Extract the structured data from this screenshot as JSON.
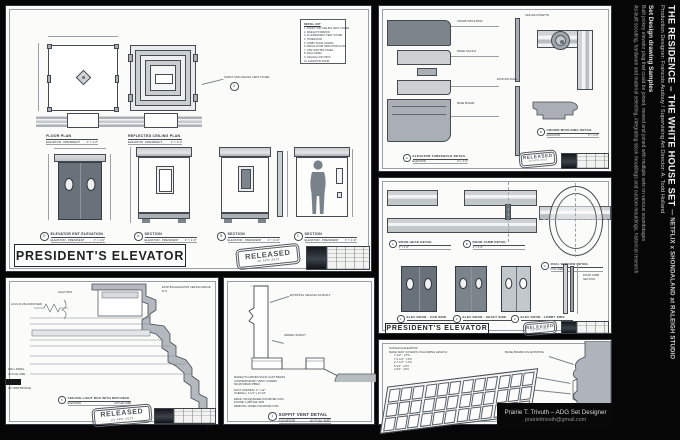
{
  "colors": {
    "bg": "#060606",
    "sheet": "#fbfbfa",
    "ink": "#30363c",
    "fill_light": "#ccd0d3",
    "fill_mid": "#a9afb4",
    "fill_dark": "#656d75"
  },
  "sidebar": {
    "title_main": "THE RESIDENCE – THE WHITE HOUSE SET ",
    "title_suffix": "—  NETFLIX x SHONDALAND at RALEIGH STUDIO",
    "credit_line": "Production Designer: Francois Audouy  /  Supervising Art Director: A. Todd Holland",
    "samples_heading": "Set Design drawing Samples",
    "samples_line1": "Built jockey elevator plug that could be joined, moved and joined with multiple sets on various soundstages",
    "samples_line2": "As-built scouting, hardware and material selecting, integrating stock mouldings and custom mouldings, historical research",
    "logo_number": "800"
  },
  "credit": {
    "name": "Prairie T. Trivuth – ADG Set Designer",
    "email": "prairiettrivuth@gmail.com"
  },
  "stamp": {
    "label": "RELEASED",
    "date": "20-APR-2023"
  },
  "plans_sheet": {
    "title_box": "PRESIDENT'S ELEVATOR",
    "detail_list": {
      "title": "DETAIL LIST",
      "items": [
        "SOFFIT AND CEILING VENT COVER",
        "SIDE EXIT MIRROR",
        "FLUORESCENT VENT COVER",
        "THRESHOLD",
        "LOBBY DOOR CASING",
        "ABOVE DOOR INDICATOR PLATE",
        "CAB CONTROL PANEL",
        "WALL PANEL",
        "CEILING LIGHT BOX",
        "ELEVATOR DOOR"
      ]
    },
    "floor_plan": {
      "title": "FLOOR PLAN",
      "sub": "ELEVATOR - PRESIDENT",
      "scale": "1\" = 1'-0\""
    },
    "rcp": {
      "title": "REFLECTED CEILING PLAN",
      "sub": "ELEVATOR - PRESIDENT",
      "scale": "1\" = 1'-0\""
    },
    "vent_note": "SOFFIT AND CEILING VENT COVER",
    "elevations": [
      {
        "letter": "D",
        "title": "ELEVATOR ENT ELEVATION",
        "sub": "ELEVATOR - PRESIDENT",
        "scale": "1\" = 1'-0\""
      },
      {
        "letter": "A",
        "title": "SECTION",
        "sub": "ELEVATOR - PRESIDENT",
        "scale": "1\" = 1'-0\""
      },
      {
        "letter": "B",
        "title": "SECTION",
        "sub": "ELEVATOR - PRESIDENT",
        "scale": "1\" = 1'-0\""
      },
      {
        "letter": "C",
        "title": "SECTION",
        "sub": "ELEVATOR - PRESIDENT",
        "scale": "1\" = 1'-0\""
      }
    ]
  },
  "moulding_sheet": {
    "caption_a": {
      "letter": "A",
      "title": "ELEVATOR THRESHOLD DETAIL",
      "sub": "ELEVATOR",
      "scale": "3\" = 1'-0\""
    },
    "caption_b": {
      "letter": "B",
      "title": "CROWN MOULDING DETAIL",
      "sub": "ELEVATOR",
      "scale": "3\" = 1'-0\""
    },
    "labels": {
      "rosette": "CEILING ROSETTE",
      "corner": "CEILING CORNER PLAN",
      "crown": "CROWN MOULDING",
      "panel": "PANEL MOULD",
      "base": "BASE BOARD",
      "wall": "EXISTING WALL"
    }
  },
  "doors_sheet": {
    "title_box": "PRESIDENT'S ELEVATOR",
    "captions_top": [
      {
        "letter": "A",
        "title": "DOOR HEAD DETAIL",
        "scale": "3\" = 1'-0\""
      },
      {
        "letter": "B",
        "title": "DOOR JAMB DETAIL",
        "scale": "3\" = 1'-0\""
      },
      {
        "letter": "C",
        "title": "OVAL WINDOW DETAIL",
        "scale": "FULL SIZE"
      }
    ],
    "captions_doors": [
      {
        "letter": "1",
        "title": "ELEV DOOR - CAB SIDE"
      },
      {
        "letter": "2",
        "title": "ELEV DOOR - SHAFT SIDE"
      },
      {
        "letter": "3",
        "title": "ELEV DOOR - LOBBY SIDE"
      },
      {
        "letter": "4",
        "title": "DOOR JAMB SECTION"
      }
    ]
  },
  "crown_sheet": {
    "labels": {
      "hvls": "HVLS FLUSH DIFFUSER",
      "light_box": "LIGHT BOX",
      "existing": "EXISTING ELEVATOR CEILING ABOVE R.O.",
      "wall_panel": "WALL PANEL",
      "actual": "ACTUAL SIZE",
      "trim": "AS TRIM PROFILE"
    },
    "caption": {
      "letter": "5",
      "title": "CEILING LIGHT BOX WITH DIFFUSER",
      "sub": "ELEVATOR",
      "scale": "ACTUAL SIZE"
    }
  },
  "soffit_sheet": {
    "labels": {
      "existing_ceiling": "EXISTING CEILING AS BUILT",
      "added_soffit": "ADDED SOFFIT"
    },
    "vendor": [
      "MADELYN CARTER SOLID CAST BRASS",
      "CONTEMPORARY VENT COVERS",
      "SKU#VCB102-PB910"
    ],
    "specs": [
      "DUCT OPENING:  2\" x 12\"",
      "OVERALL:  3 1/4\" x 13 1/2\""
    ],
    "contact": [
      "EMAIL: INFO@MADELYNCARTER.COM",
      "PHONE: 1-866-620-4235",
      "WEBSITE: MADELYNCARTER.COM"
    ],
    "caption": {
      "letter": "1",
      "title": "SOFFIT VENT DETAIL",
      "sub": "ELEVATOR",
      "scale": "ACTUAL SIZE"
    }
  },
  "vent_sheet": {
    "notes": [
      "FOR EACH ELEVATOR",
      "MAKE VENT COVER IN FOLLOWING LENGTH:",
      "7'-1/2\" : 2 PC",
      "7'-1 1/4\" : 1 PC",
      "2'-7 1/4\" : 1 PC",
      "6 1/4\" : 2 PC",
      "4 3/4\" : 4 PC"
    ],
    "labels": {
      "base": "BASE BOARD AS EXISTING",
      "vent": "BRASS VENT COVER",
      "paint": "PAINT BLACK"
    }
  }
}
